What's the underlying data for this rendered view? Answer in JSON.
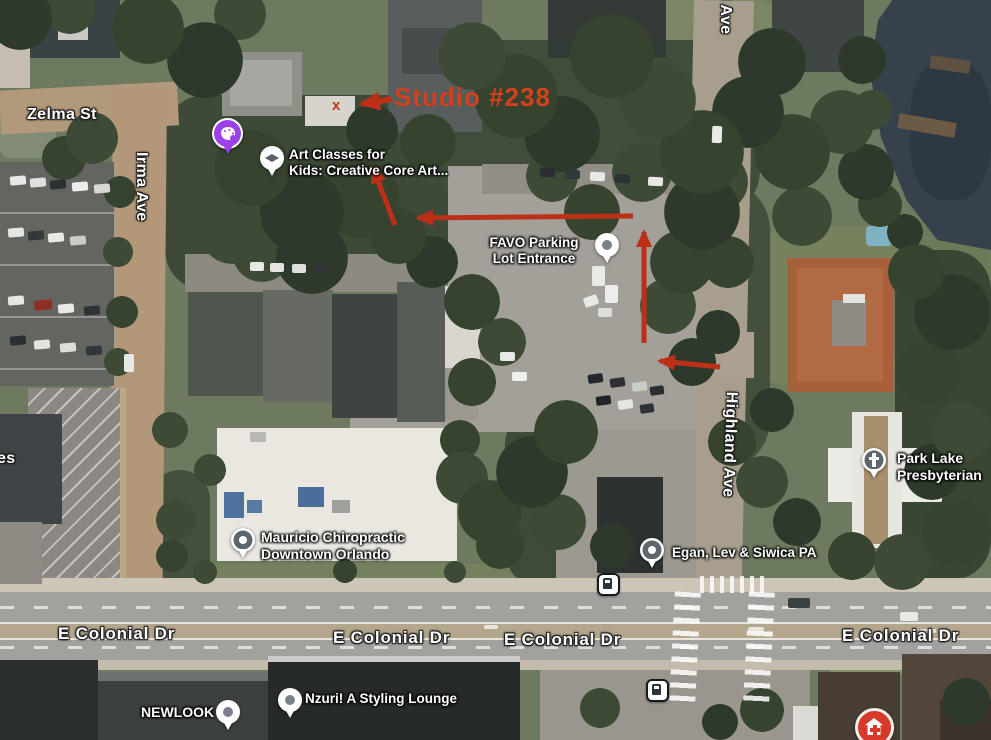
{
  "app": "satellite-map-with-directions",
  "annotations": {
    "studio_label": "Studio #238",
    "x_marker": "x",
    "label_color": "#d2421f",
    "arrow_color": "#bd3018",
    "arrow_count": 5
  },
  "streets": {
    "zelma": "Zelma St",
    "irma": "Irma Ave",
    "highland": "Highland Ave",
    "highland_top_partial": "d Ave",
    "colonial": [
      "E Colonial Dr",
      "E Colonial Dr",
      "E Colonial Dr",
      "E Colonial Dr"
    ],
    "left_edge_partial": "es"
  },
  "places": {
    "art_classes": {
      "line1": "Art Classes for",
      "line2": "Kids: Creative Core Art...",
      "icon": "education-pin"
    },
    "favo": {
      "line1": "FAVO Parking",
      "line2": "Lot Entrance",
      "icon": "location-pin"
    },
    "mauricio": {
      "line1": "Mauricio Chiropractic",
      "line2": "Downtown Orlando",
      "icon": "poi-pin"
    },
    "egan": {
      "label": "Egan, Lev & Siwica PA",
      "icon": "poi-pin"
    },
    "park_lake": {
      "line1": "Park Lake",
      "line2": "Presbyterian",
      "icon": "church-pin"
    },
    "newlook": {
      "label": "NEWLOOK",
      "icon": "location-pin"
    },
    "nzuri": {
      "label": "Nzuri! A Styling Lounge",
      "icon": "location-pin"
    }
  },
  "icons": {
    "art_store": "palette-pin",
    "bus_stops": "bus-stop-icon",
    "hospital": "hospital-icon"
  },
  "colors": {
    "palette_pin": "#9c40e8",
    "hospital_red": "#d7392b",
    "water": "#37414c"
  }
}
